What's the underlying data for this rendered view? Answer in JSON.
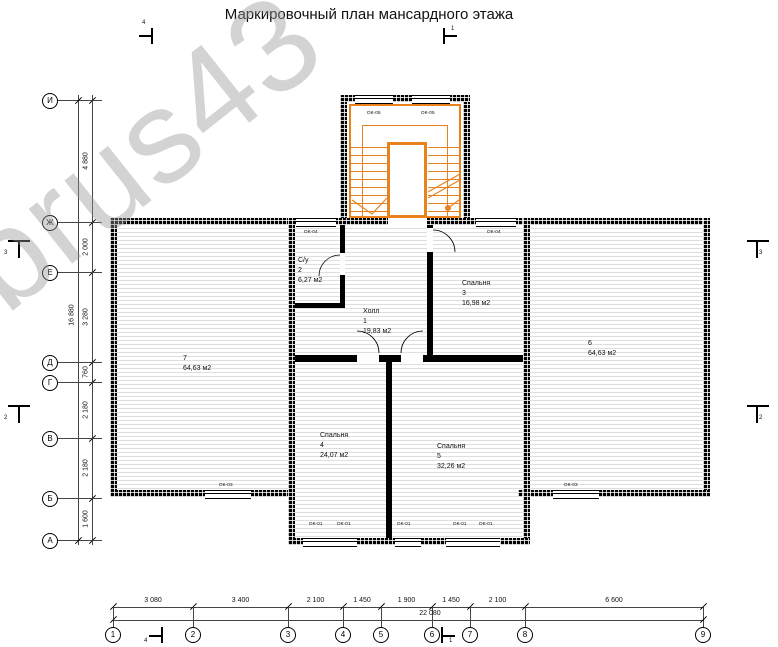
{
  "title": "Маркировочный план мансардного этажа",
  "watermark": "profbrus43",
  "colors": {
    "stair_orange": "#e8821f",
    "wall": "#000000",
    "hatch_line": "#dedede",
    "watermark_gray": "#969696"
  },
  "rooms": {
    "hall": {
      "name": "Холл",
      "number": "1",
      "area": "19,83 м2"
    },
    "su": {
      "name": "С/у",
      "number": "2",
      "area": "6,27 м2"
    },
    "bed3": {
      "name": "Спальня",
      "number": "3",
      "area": "16,98 м2"
    },
    "bed4": {
      "name": "Спальня",
      "number": "4",
      "area": "24,07 м2"
    },
    "bed5": {
      "name": "Спальня",
      "number": "5",
      "area": "32,26 м2"
    },
    "r6": {
      "number": "6",
      "area": "64,63 м2"
    },
    "r7": {
      "number": "7",
      "area": "64,63 м2"
    }
  },
  "window_tags": {
    "stair_left": "ОК-05",
    "stair_right": "ОК-05",
    "top_left": "ОК-04",
    "top_right": "ОК-04",
    "bottom_1": "ОК-01",
    "bottom_2": "ОК-01",
    "bottom_3": "ОК-01",
    "bottom_4": "ОК-01",
    "bottom_5": "ОК-01",
    "wing_left": "ОК-03",
    "wing_right": "ОК-03"
  },
  "axes": {
    "rows": [
      {
        "label": "И",
        "y": 100
      },
      {
        "label": "Ж",
        "y": 222
      },
      {
        "label": "Е",
        "y": 272
      },
      {
        "label": "Д",
        "y": 362
      },
      {
        "label": "Г",
        "y": 382
      },
      {
        "label": "В",
        "y": 438
      },
      {
        "label": "Б",
        "y": 498
      },
      {
        "label": "А",
        "y": 540
      }
    ],
    "row_dims": [
      "4 880",
      "2 000",
      "3 280",
      "760",
      "2 180",
      "2 180",
      "1 600"
    ],
    "row_total": "16 880",
    "cols": [
      {
        "label": "1",
        "x": 113
      },
      {
        "label": "2",
        "x": 193
      },
      {
        "label": "3",
        "x": 288
      },
      {
        "label": "4",
        "x": 343
      },
      {
        "label": "5",
        "x": 381
      },
      {
        "label": "6",
        "x": 432
      },
      {
        "label": "7",
        "x": 470
      },
      {
        "label": "8",
        "x": 525
      },
      {
        "label": "9",
        "x": 703
      }
    ],
    "col_dims": [
      "3 080",
      "3 400",
      "2 100",
      "1 450",
      "1 900",
      "1 450",
      "2 100",
      "6 600"
    ],
    "col_total": "22 080"
  },
  "section_markers": {
    "top_left": "4",
    "top_center": "1",
    "bottom_left": "4",
    "bottom_center": "1",
    "left_upper": "3",
    "left_lower": "2",
    "right_upper": "3",
    "right_lower": "2"
  }
}
